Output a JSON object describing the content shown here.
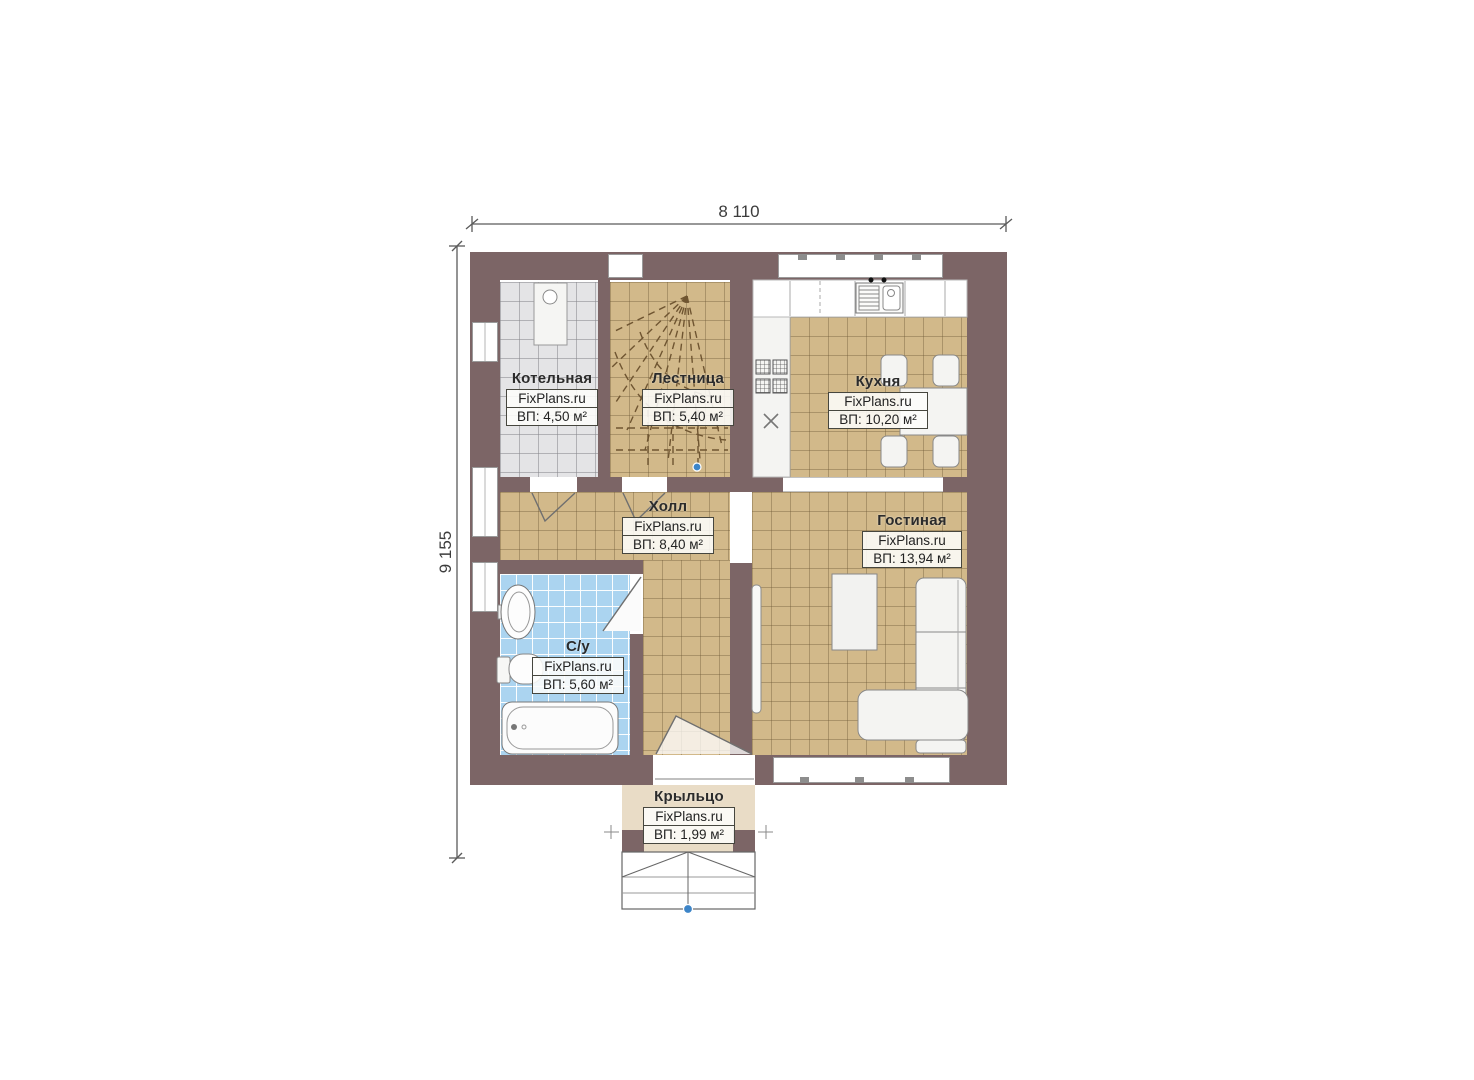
{
  "dimensions": {
    "width_label": "8 110",
    "height_label": "9 155"
  },
  "rooms": [
    {
      "id": "boiler",
      "name": "Котельная",
      "watermark": "FixPlans.ru",
      "area": "ВП: 4,50 м²"
    },
    {
      "id": "stairs",
      "name": "Лестница",
      "watermark": "FixPlans.ru",
      "area": "ВП: 5,40 м²"
    },
    {
      "id": "kitchen",
      "name": "Кухня",
      "watermark": "FixPlans.ru",
      "area": "ВП: 10,20 м²"
    },
    {
      "id": "hall",
      "name": "Холл",
      "watermark": "FixPlans.ru",
      "area": "ВП: 8,40 м²"
    },
    {
      "id": "living",
      "name": "Гостиная",
      "watermark": "FixPlans.ru",
      "area": "ВП: 13,94 м²"
    },
    {
      "id": "bath",
      "name": "С/у",
      "watermark": "FixPlans.ru",
      "area": "ВП: 5,60 м²"
    },
    {
      "id": "porch",
      "name": "Крыльцо",
      "watermark": "FixPlans.ru",
      "area": "ВП: 1,99 м²"
    }
  ],
  "colors": {
    "wall": "#7c6566",
    "floor_main": "#d2b98a",
    "floor_boiler": "#e4e4e6",
    "floor_bath": "#abd4f0",
    "floor_porch": "#e9dcc6",
    "furniture": "#f4f4f2",
    "reference_marker": "#3d85c8"
  }
}
